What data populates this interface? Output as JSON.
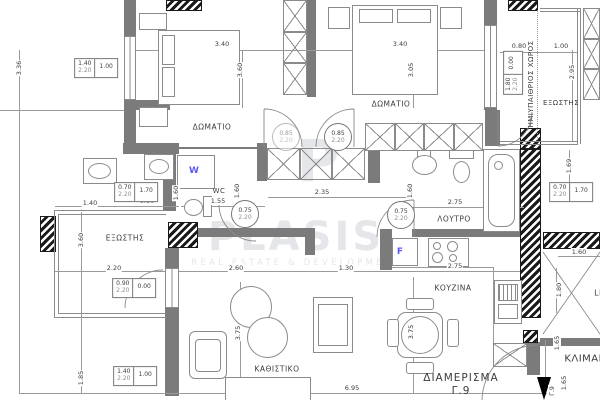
{
  "colors": {
    "wall": "#7b7b7b",
    "line": "#9a9a9a",
    "ink": "#3c3c3c",
    "appliance_letter": "#5a5af0",
    "watermark": "#e4e6e9"
  },
  "watermark": {
    "logo_letter": "P",
    "brand": "PLASIS",
    "tagline": "REAL ESTATE & DEVELOPMENT"
  },
  "apartment": {
    "title": "ΔΙΑΜΕΡΙΣΜΑ",
    "unit": "Γ.9"
  },
  "room_labels": [
    {
      "name": "bedroom-1",
      "text": "ΔΩΜΑΤΙΟ",
      "x": 212,
      "y": 127
    },
    {
      "name": "bedroom-2",
      "text": "ΔΩΜΑΤΙΟ",
      "x": 391,
      "y": 104
    },
    {
      "name": "wc",
      "text": "WC",
      "x": 219,
      "y": 191,
      "size": 7
    },
    {
      "name": "bathroom",
      "text": "ΛΟΥΤΡΟ",
      "x": 454,
      "y": 219
    },
    {
      "name": "balcony-left",
      "text": "ΕΞΩΣΤΗΣ",
      "x": 125,
      "y": 238
    },
    {
      "name": "balcony-right",
      "text": "ΕΞΩΣΤΗΣ",
      "x": 561,
      "y": 103,
      "size": 7
    },
    {
      "name": "semi-open-space",
      "text": "ΗΜΙΥΠΑΙΘΡΙΟΣ ΧΩΡΟΣ",
      "x": 531,
      "y": 84,
      "vertical": true,
      "size": 7
    },
    {
      "name": "kitchen",
      "text": "ΚΟΥΖΙΝΑ",
      "x": 453,
      "y": 288
    },
    {
      "name": "living-room",
      "text": "ΚΑΘΙΣΤΙΚΟ",
      "x": 277,
      "y": 369
    },
    {
      "name": "staircase",
      "text": "ΚΛΙΜΑΚ",
      "x": 585,
      "y": 359,
      "size": 10
    },
    {
      "name": "lift",
      "text": "LI",
      "x": 598,
      "y": 293,
      "size": 8
    }
  ],
  "appliance_letters": [
    {
      "name": "washing-machine-letter",
      "text": "W",
      "x": 194,
      "y": 171
    },
    {
      "name": "fridge-letter",
      "text": "F",
      "x": 400,
      "y": 252
    }
  ],
  "dims": [
    {
      "text": "3.40",
      "x": 222,
      "y": 44
    },
    {
      "text": "3.40",
      "x": 400,
      "y": 44
    },
    {
      "text": "0.80",
      "x": 519,
      "y": 46
    },
    {
      "text": "1.00",
      "x": 561,
      "y": 46
    },
    {
      "text": "1.40",
      "x": 90,
      "y": 203
    },
    {
      "text": "0.80",
      "x": 147,
      "y": 201
    },
    {
      "text": "1.55",
      "x": 218,
      "y": 201
    },
    {
      "text": "2.35",
      "x": 322,
      "y": 192
    },
    {
      "text": "2.75",
      "x": 455,
      "y": 202
    },
    {
      "text": "2.20",
      "x": 114,
      "y": 268
    },
    {
      "text": "2.60",
      "x": 236,
      "y": 268
    },
    {
      "text": "1.30",
      "x": 346,
      "y": 268
    },
    {
      "text": "2.75",
      "x": 455,
      "y": 266
    },
    {
      "text": "6.95",
      "x": 352,
      "y": 388
    },
    {
      "text": "1.60",
      "x": 579,
      "y": 252
    },
    {
      "text": "3.36",
      "x": 19,
      "y": 68,
      "vertical": true
    },
    {
      "text": "3.60",
      "x": 240,
      "y": 70,
      "vertical": true
    },
    {
      "text": "3.05",
      "x": 411,
      "y": 70,
      "vertical": true
    },
    {
      "text": "2.95",
      "x": 572,
      "y": 72,
      "vertical": true
    },
    {
      "text": "1.60",
      "x": 176,
      "y": 193,
      "vertical": true
    },
    {
      "text": "1.60",
      "x": 237,
      "y": 191,
      "vertical": true
    },
    {
      "text": "1.60",
      "x": 410,
      "y": 191,
      "vertical": true
    },
    {
      "text": "1.69",
      "x": 569,
      "y": 166,
      "vertical": true
    },
    {
      "text": "3.60",
      "x": 81,
      "y": 240,
      "vertical": true
    },
    {
      "text": "1.85",
      "x": 81,
      "y": 378,
      "vertical": true
    },
    {
      "text": "3.75",
      "x": 238,
      "y": 333,
      "vertical": true
    },
    {
      "text": "3.75",
      "x": 411,
      "y": 332,
      "vertical": true
    },
    {
      "text": "1.80",
      "x": 559,
      "y": 290,
      "vertical": true
    },
    {
      "text": "1.65",
      "x": 557,
      "y": 343,
      "vertical": true
    },
    {
      "text": "1.65",
      "x": 564,
      "y": 383,
      "vertical": true
    },
    {
      "text": "Γ.9",
      "x": 552,
      "y": 391,
      "vertical": true
    }
  ],
  "dim_boxes": [
    {
      "top": "1.40",
      "bot": "2.20",
      "side": "1.00",
      "x": 96,
      "y": 68
    },
    {
      "top": "0.70",
      "bot": "2.20",
      "side": "1.70",
      "x": 136,
      "y": 192
    },
    {
      "top": "0.90",
      "bot": "2.20",
      "side": "0.00",
      "x": 134,
      "y": 288
    },
    {
      "top": "1.40",
      "bot": "2.20",
      "side": "1.00",
      "x": 135,
      "y": 376
    },
    {
      "top": "0.70",
      "bot": "2.20",
      "side": "1.70",
      "x": 571,
      "y": 192
    },
    {
      "top": "1.80",
      "bot": "2.20",
      "side": "0.00",
      "x": 513,
      "y": 73,
      "rot": -90
    }
  ],
  "dim_circles": [
    {
      "top": "0.85",
      "bot": "2.20",
      "x": 286,
      "y": 137,
      "faded": true
    },
    {
      "top": "0.85",
      "bot": "2.20",
      "x": 338,
      "y": 137
    },
    {
      "top": "0.75",
      "bot": "2.20",
      "x": 245,
      "y": 214
    },
    {
      "top": "0.75",
      "bot": "2.20",
      "x": 401,
      "y": 215
    }
  ]
}
